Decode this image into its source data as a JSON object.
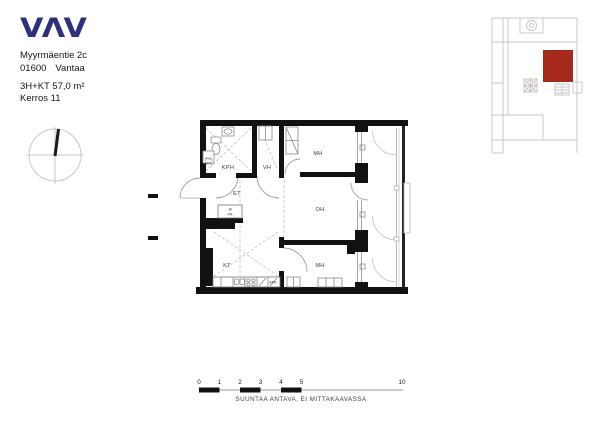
{
  "colors": {
    "logo_blue": "#2d2f7f",
    "highlight_red": "#a72b1d",
    "wall_black": "#111111",
    "line_gray": "#c6c4c1"
  },
  "header": {
    "logo_text": "VΛV",
    "street": "Myyrmäentie 2c",
    "postal_code": "01600",
    "city": "Vantaa",
    "apartment_info": "3H+KT 57,0 m²",
    "floor_info": "Kerros 11"
  },
  "floor_plan": {
    "room_labels": {
      "bathroom": "KPH",
      "closet": "VH",
      "bedroom_top": "MH",
      "entrance": "ET",
      "living_room": "OH",
      "kitchen": "KT",
      "bedroom_bottom": "MH"
    },
    "appliance_labels": {
      "dishwasher": "APK",
      "washer_line1": "(PK)",
      "washer_line2": "(PP)",
      "fridge_line1": "JK",
      "fridge_line2": "PA"
    }
  },
  "scale_bar": {
    "ticks": [
      "0",
      "1",
      "2",
      "3",
      "4",
      "5",
      "10"
    ],
    "caption": "SUUNTAA ANTAVA, EI MITTAKAAVASSA"
  }
}
